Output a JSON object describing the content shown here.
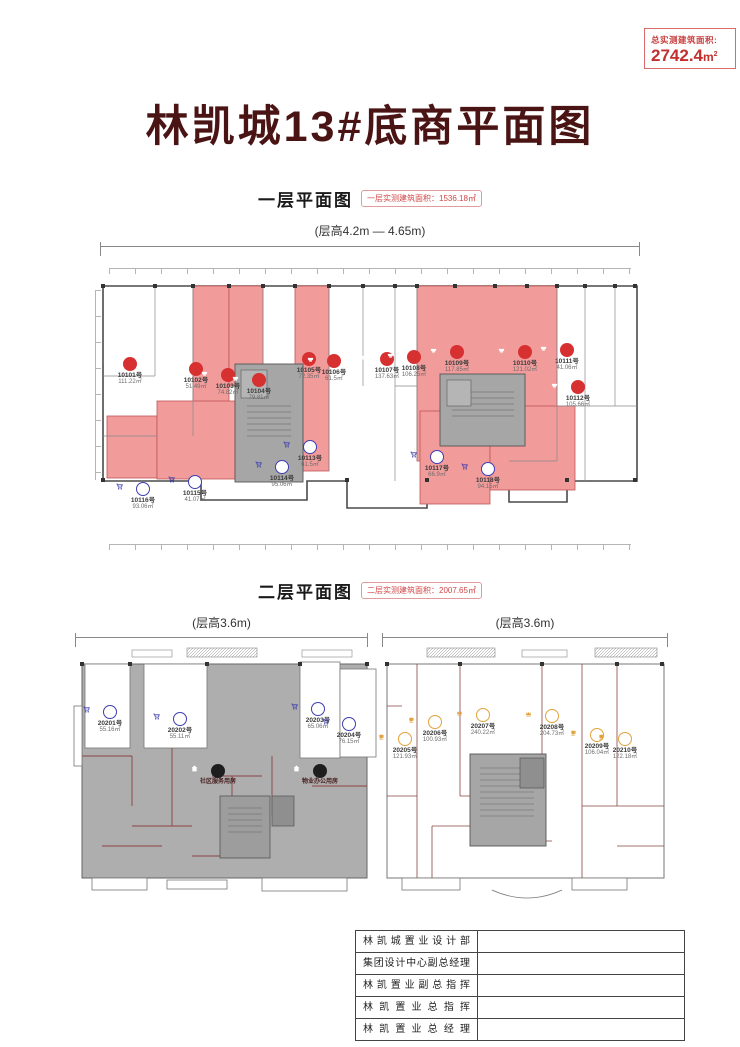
{
  "header": {
    "total_box": {
      "label": "总实测建筑面积:",
      "value": "2742.4",
      "unit_base": "m",
      "unit_sup": "2"
    },
    "title": "林凯城13#底商平面图"
  },
  "floor1": {
    "section_title": "一层平面图",
    "area_badge": "一层实测建筑面积：1536.18㎡",
    "floor_height": "(层高4.2m — 4.65m)",
    "units": [
      {
        "id": "10101号",
        "area": "111.22㎡",
        "icon": "dish-icon",
        "x": 35,
        "y": 101
      },
      {
        "id": "10102号",
        "area": "51.49㎡",
        "icon": "dish-icon",
        "x": 101,
        "y": 106
      },
      {
        "id": "10103号",
        "area": "74.82㎡",
        "icon": "dish-icon",
        "x": 133,
        "y": 112
      },
      {
        "id": "10104号",
        "area": "79.81㎡",
        "icon": "dish-icon",
        "x": 164,
        "y": 117
      },
      {
        "id": "10105号",
        "area": "72.35㎡",
        "icon": "dish-icon",
        "x": 214,
        "y": 96
      },
      {
        "id": "10106号",
        "area": "61.5㎡",
        "icon": "dish-icon",
        "x": 239,
        "y": 98
      },
      {
        "id": "10107号",
        "area": "137.63㎡",
        "icon": "dish-icon",
        "x": 292,
        "y": 96
      },
      {
        "id": "10108号",
        "area": "106.25㎡",
        "icon": "dish-icon",
        "x": 319,
        "y": 94
      },
      {
        "id": "10109号",
        "area": "117.85㎡",
        "icon": "dish-icon",
        "x": 362,
        "y": 89
      },
      {
        "id": "10110号",
        "area": "121.02㎡",
        "icon": "dish-icon",
        "x": 430,
        "y": 89
      },
      {
        "id": "10111号",
        "area": "41.06㎡",
        "icon": "dish-icon",
        "x": 472,
        "y": 87
      },
      {
        "id": "10112号",
        "area": "105.66㎡",
        "icon": "dish-icon",
        "x": 483,
        "y": 124
      },
      {
        "id": "10113号",
        "area": "61.5㎡",
        "icon": "cart-icon",
        "x": 215,
        "y": 184
      },
      {
        "id": "10114号",
        "area": "95.06㎡",
        "icon": "cart-icon",
        "x": 187,
        "y": 204
      },
      {
        "id": "10115号",
        "area": "41.07㎡",
        "icon": "cart-icon",
        "x": 100,
        "y": 219
      },
      {
        "id": "10116号",
        "area": "93.06㎡",
        "icon": "cart-icon",
        "x": 48,
        "y": 226
      },
      {
        "id": "10117号",
        "area": "66.9㎡",
        "icon": "cart-icon",
        "x": 342,
        "y": 194
      },
      {
        "id": "10118号",
        "area": "94.15㎡",
        "icon": "cart-icon",
        "x": 393,
        "y": 206
      }
    ]
  },
  "floor2": {
    "section_title": "二层平面图",
    "area_badge": "二层实测建筑面积：2007.65㎡",
    "floor_height_left": "(层高3.6m)",
    "floor_height_right": "(层高3.6m)",
    "units": [
      {
        "id": "20201号",
        "area": "55.16㎡",
        "icon": "cart-icon",
        "x": 38,
        "y": 59
      },
      {
        "id": "20202号",
        "area": "55.11㎡",
        "icon": "cart-icon",
        "x": 108,
        "y": 66
      },
      {
        "id": "20203号",
        "area": "65.06㎡",
        "icon": "cart-icon",
        "x": 246,
        "y": 56
      },
      {
        "id": "20204号",
        "area": "76.15㎡",
        "icon": "cart-icon",
        "x": 277,
        "y": 71
      },
      {
        "id": "20205号",
        "area": "121.93㎡",
        "icon": "cup-icon",
        "x": 333,
        "y": 86
      },
      {
        "id": "20206号",
        "area": "100.93㎡",
        "icon": "cup-icon",
        "x": 363,
        "y": 69
      },
      {
        "id": "20207号",
        "area": "240.22㎡",
        "icon": "crown-icon",
        "x": 411,
        "y": 62
      },
      {
        "id": "20208号",
        "area": "204.73㎡",
        "icon": "crown-icon",
        "x": 480,
        "y": 63
      },
      {
        "id": "20209号",
        "area": "106.04㎡",
        "icon": "cup-icon",
        "x": 525,
        "y": 82
      },
      {
        "id": "20210号",
        "area": "122.18㎡",
        "icon": "cup-icon",
        "x": 553,
        "y": 86
      }
    ],
    "facilities": [
      {
        "label": "社区服务用房",
        "icon": "house-icon",
        "x": 146,
        "y": 118
      },
      {
        "label": "物业办公用房",
        "icon": "house-icon",
        "x": 248,
        "y": 118
      }
    ]
  },
  "signature_table": {
    "rows": [
      "林凯城置业设计部",
      "集团设计中心副总经理",
      "林凯置业副总指挥",
      "林凯置业总指挥",
      "林凯置业总经理"
    ]
  },
  "colors": {
    "accent_red": "#C94040",
    "unit_fill": "#F19B9B",
    "core_gray": "#A6A6A6",
    "icon_red": "#D63031",
    "icon_blue": "#3D3DB0",
    "icon_orange": "#E2A23B",
    "title_color": "#4A1414"
  }
}
